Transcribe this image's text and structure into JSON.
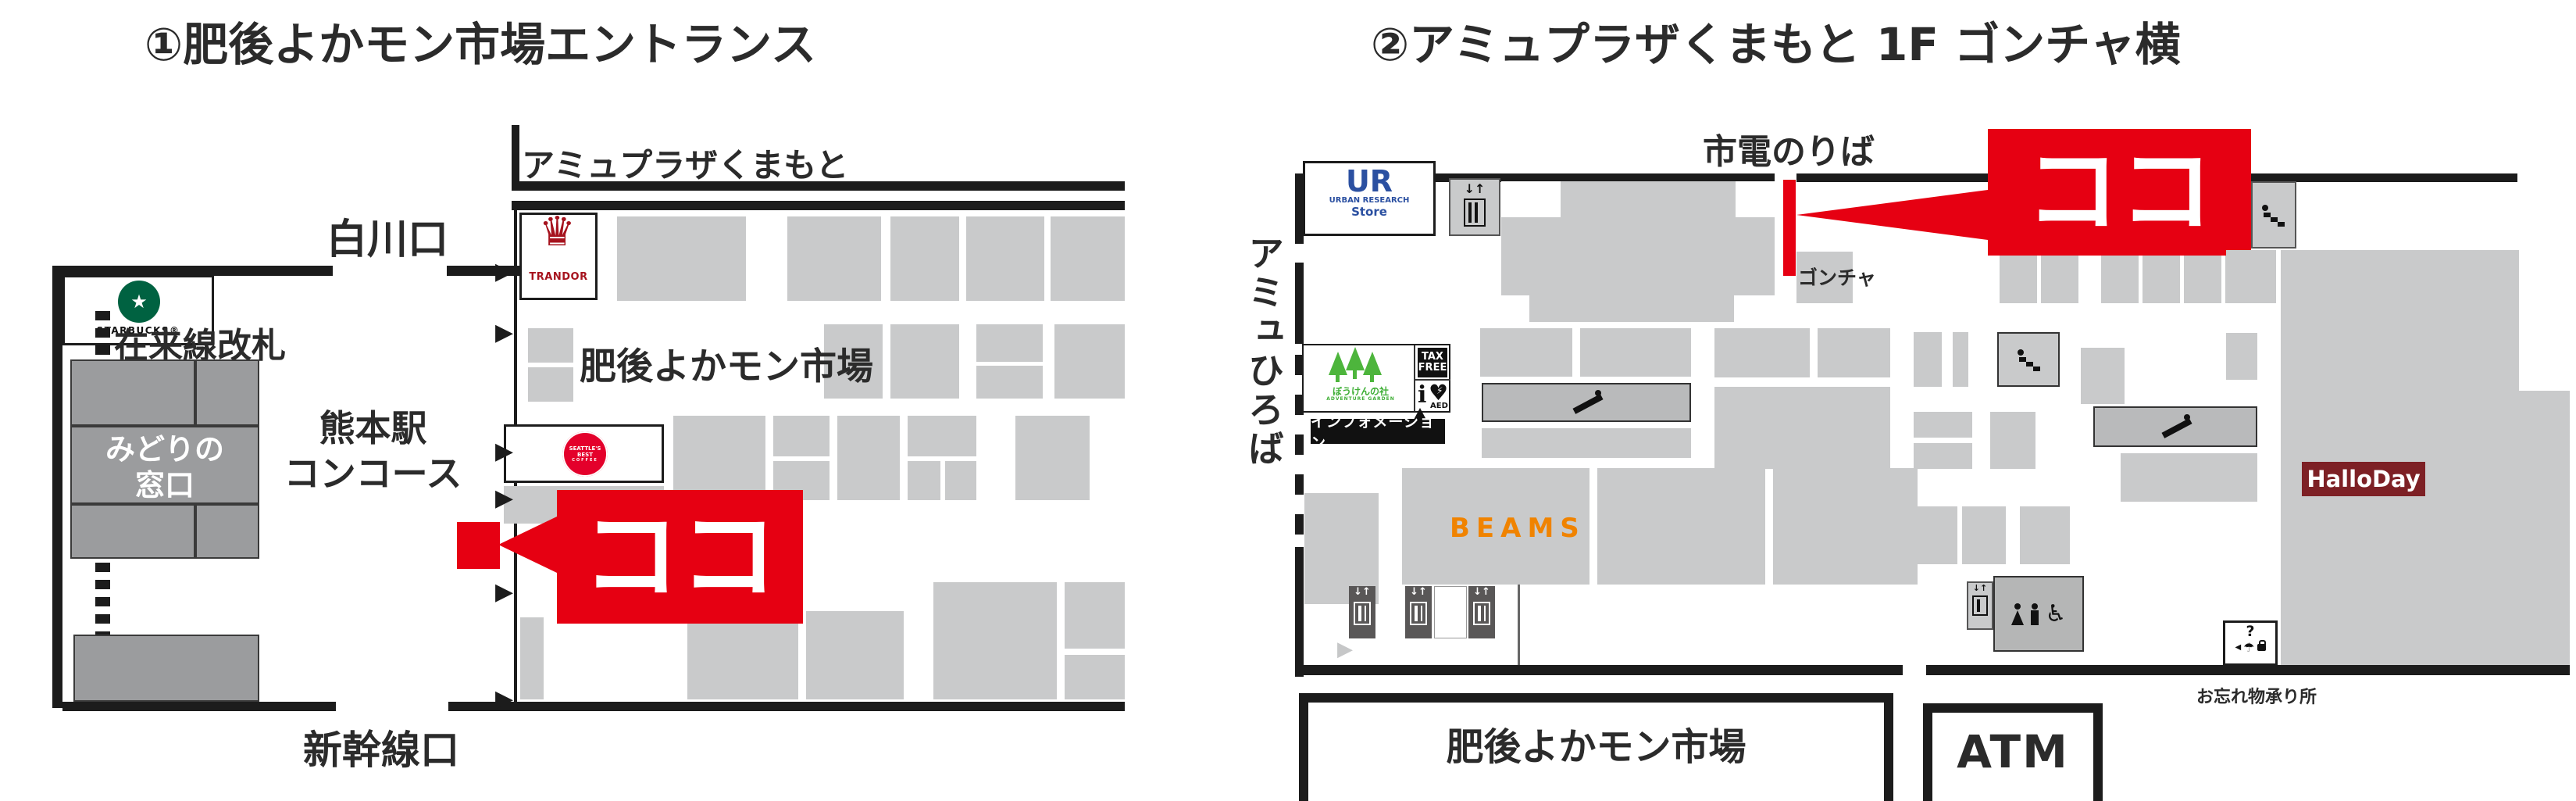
{
  "left_map": {
    "title": "①肥後よかモン市場エントランス",
    "amu_plaza_label": "アミュプラザくまもと",
    "shirakawa_label": "白川口",
    "zairaisen_label": "在来線改札",
    "midori_line1": "みどりの",
    "midori_line2": "窓口",
    "concourse_line1": "熊本駅",
    "concourse_line2": "コンコース",
    "market_label": "肥後よかモン市場",
    "shinkansen_label": "新幹線口",
    "koko_label": "ココ",
    "starbucks_label": "STARBUCKS®",
    "trandor_label": "TRANDOR",
    "seattles_line1": "SEATTLE'S BEST",
    "seattles_line2": "COFFEE"
  },
  "right_map": {
    "title": "②アミュプラザくまもと 1F ゴンチャ横",
    "shiden_label": "市電のりば",
    "amu_hiroba_label": "アミュひろば",
    "koko_label": "ココ",
    "gongcha_label": "ゴンチャ",
    "ur_label": "UR",
    "ur_sub_label": "URBAN RESEARCH",
    "ur_store_label": "Store",
    "bouken_label": "ぼうけんの社",
    "adventure_label": "ADVENTURE GARDEN",
    "taxfree_line1": "TAX",
    "taxfree_line2": "FREE",
    "info_i_label": "i",
    "aed_label": "AED",
    "information_label": "インフォメーション",
    "beams_label": "BEAMS",
    "halloday_label": "HalloDay",
    "market_label": "肥後よかモン市場",
    "atm_label": "ATM",
    "lost_found_label": "お忘れ物承り所",
    "lost_found_q": "?"
  },
  "icons": {
    "arrow_right": "▶",
    "arrow_right_gray": "▶",
    "elevator_arrows": "↓↑",
    "umbrella": "☂",
    "wheelchair": "♿",
    "star": "★",
    "heart": "♥",
    "bolt": "⚡",
    "crown": "♛",
    "tri_left_small": "◀"
  },
  "colors": {
    "accent_red": "#e60012",
    "beams_orange": "#f08300",
    "ur_blue": "#2b50a1",
    "halloday_red": "#7d2025",
    "tree_green": "#4db53c",
    "starbucks_green": "#006241",
    "seattles_red": "#e4002b",
    "trandor_red": "#a6131e",
    "block_gray": "#c9cacb",
    "dark_gray": "#9b9c9e"
  }
}
